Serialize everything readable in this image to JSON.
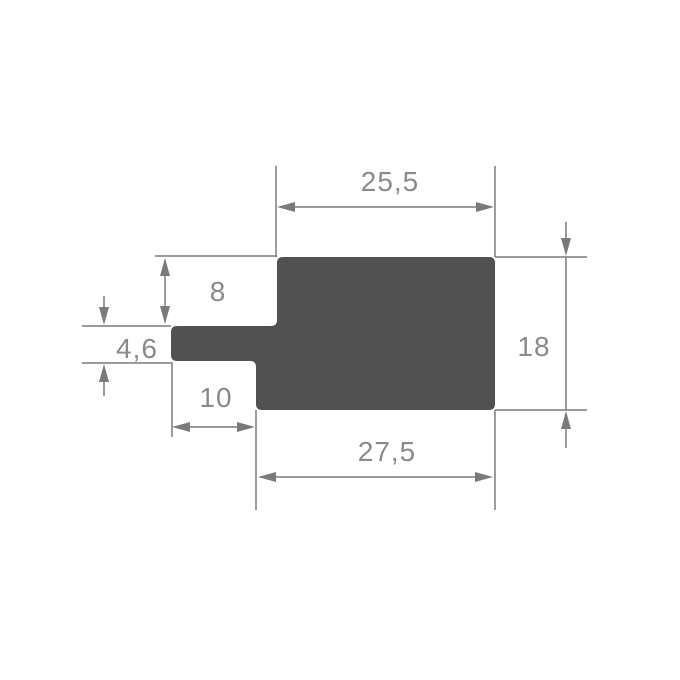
{
  "drawing": {
    "title": "profile-cross-section-dimension-drawing",
    "dimensions": {
      "top_width": "25,5",
      "left_step_height": "8",
      "tab_height": "4,6",
      "tab_width": "10",
      "total_height": "18",
      "bottom_width": "27,5"
    },
    "colors": {
      "profile_fill": "#515151",
      "line": "#7a7a7a",
      "text": "#8a8a8a",
      "background": "#ffffff"
    }
  }
}
